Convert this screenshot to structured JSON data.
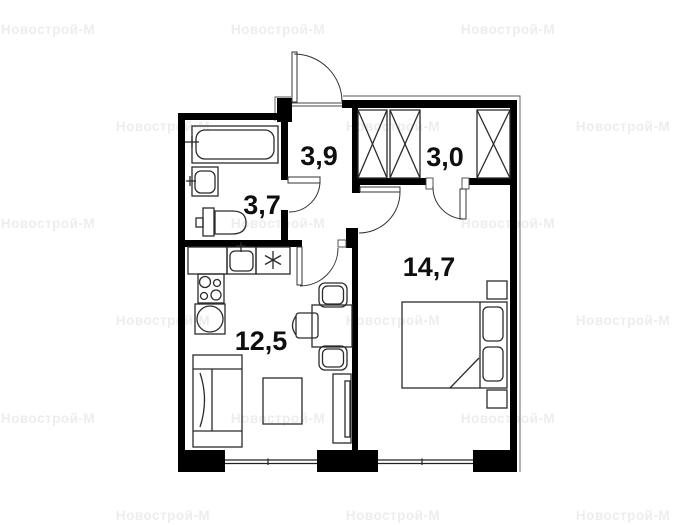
{
  "watermark": {
    "text": "Новострой-М",
    "color": "#ededed"
  },
  "plan": {
    "colors": {
      "wall": "#000000",
      "line": "#2b2b2b",
      "label": "#0f0f0f"
    },
    "rooms": [
      {
        "name": "hallway",
        "area_label": "3,9"
      },
      {
        "name": "walk-in-closet",
        "area_label": "3,0"
      },
      {
        "name": "bathroom",
        "area_label": "3,7"
      },
      {
        "name": "bedroom",
        "area_label": "14,7"
      },
      {
        "name": "kitchen-living-room",
        "area_label": "12,5"
      }
    ]
  }
}
